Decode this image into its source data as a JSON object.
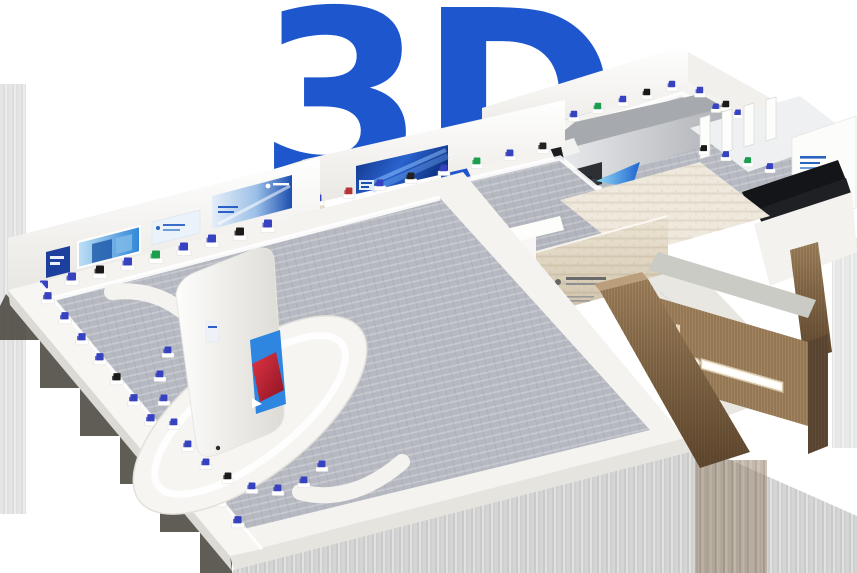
{
  "hero": {
    "logo_text": "3D",
    "logo_color": "#1e56cd"
  },
  "scene": {
    "description_name": "virtual-exhibition-hall-3d-model",
    "colors": {
      "background": "#ffffff",
      "carpet": "#b6b9c1",
      "platform": "#f4f3ef",
      "wall": "#fbfbfa",
      "travertine": "#e4dbc9",
      "wood_light": "#a2845f",
      "wood_dark": "#6b5138",
      "banner_blue": "#11337f",
      "screen_blue": "#2f86e0",
      "accent_red": "#c3242f",
      "exhibit_blue": "#3742c0",
      "exhibit_green": "#1d9e4f",
      "theater_gray": "#b4b7bb",
      "panel_black": "#141518",
      "beam_blue": "#1760cf"
    }
  }
}
